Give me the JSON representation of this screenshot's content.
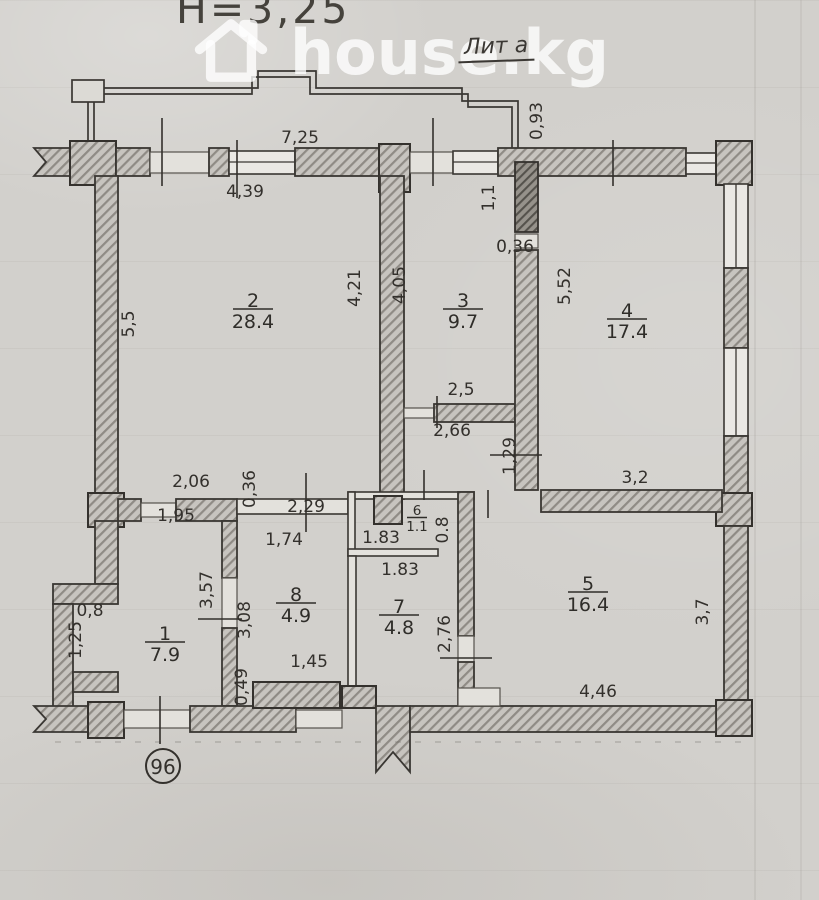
{
  "document": {
    "height_note": "Н=3,25",
    "liter_label": "Лит а",
    "unit_number": "96"
  },
  "watermark": {
    "text": "house.kg",
    "icon": "house-icon"
  },
  "colors": {
    "paper": "#d2d0cc",
    "ink": "#33302c",
    "hatch_fill": "#c7c4bf",
    "hatch_stroke": "#8f8b85",
    "watermark_white": "rgba(255,255,255,0.78)"
  },
  "rooms": [
    {
      "number": "2",
      "area": "28.4",
      "x": 253,
      "y": 301,
      "small": false
    },
    {
      "number": "3",
      "area": "9.7",
      "x": 463,
      "y": 301,
      "small": false
    },
    {
      "number": "4",
      "area": "17.4",
      "x": 627,
      "y": 311,
      "small": false
    },
    {
      "number": "5",
      "area": "16.4",
      "x": 588,
      "y": 584,
      "small": false
    },
    {
      "number": "6",
      "area": "1.1",
      "x": 417,
      "y": 511,
      "small": true
    },
    {
      "number": "7",
      "area": "4.8",
      "x": 399,
      "y": 607,
      "small": false
    },
    {
      "number": "8",
      "area": "4.9",
      "x": 296,
      "y": 595,
      "small": false
    },
    {
      "number": "1",
      "area": "7.9",
      "x": 165,
      "y": 634,
      "small": false
    }
  ],
  "dimensions": [
    {
      "text": "7,25",
      "x": 300,
      "y": 138,
      "rot": 0
    },
    {
      "text": "4,39",
      "x": 245,
      "y": 192,
      "rot": 0
    },
    {
      "text": "0,93",
      "x": 537,
      "y": 121,
      "rot": -90
    },
    {
      "text": "5,5",
      "x": 129,
      "y": 324,
      "rot": -90
    },
    {
      "text": "4,21",
      "x": 355,
      "y": 288,
      "rot": -90
    },
    {
      "text": "4,05",
      "x": 400,
      "y": 285,
      "rot": -90
    },
    {
      "text": "1,1",
      "x": 489,
      "y": 198,
      "rot": -90
    },
    {
      "text": "0,36",
      "x": 515,
      "y": 247,
      "rot": 0
    },
    {
      "text": "5,52",
      "x": 565,
      "y": 286,
      "rot": -90
    },
    {
      "text": "2,5",
      "x": 461,
      "y": 390,
      "rot": 0
    },
    {
      "text": "2,66",
      "x": 452,
      "y": 431,
      "rot": 0
    },
    {
      "text": "1,29",
      "x": 510,
      "y": 456,
      "rot": -90
    },
    {
      "text": "3,2",
      "x": 635,
      "y": 478,
      "rot": 0
    },
    {
      "text": "2,06",
      "x": 191,
      "y": 482,
      "rot": 0
    },
    {
      "text": "0,36",
      "x": 250,
      "y": 489,
      "rot": -90
    },
    {
      "text": "2,29",
      "x": 306,
      "y": 507,
      "rot": 0
    },
    {
      "text": "1,95",
      "x": 176,
      "y": 516,
      "rot": 0
    },
    {
      "text": "1,74",
      "x": 284,
      "y": 540,
      "rot": 0
    },
    {
      "text": "1.83",
      "x": 381,
      "y": 538,
      "rot": 0
    },
    {
      "text": "0.8",
      "x": 443,
      "y": 530,
      "rot": -90
    },
    {
      "text": "1.83",
      "x": 400,
      "y": 570,
      "rot": 0
    },
    {
      "text": "3,57",
      "x": 207,
      "y": 590,
      "rot": -90
    },
    {
      "text": "3,08",
      "x": 245,
      "y": 620,
      "rot": -90
    },
    {
      "text": "2,76",
      "x": 445,
      "y": 634,
      "rot": -90
    },
    {
      "text": "0,8",
      "x": 90,
      "y": 611,
      "rot": 0
    },
    {
      "text": "1,25",
      "x": 76,
      "y": 640,
      "rot": -90
    },
    {
      "text": "1,45",
      "x": 309,
      "y": 662,
      "rot": 0
    },
    {
      "text": "0,49",
      "x": 242,
      "y": 687,
      "rot": -90
    },
    {
      "text": "4,46",
      "x": 598,
      "y": 692,
      "rot": 0
    },
    {
      "text": "3,7",
      "x": 703,
      "y": 612,
      "rot": -90
    }
  ]
}
